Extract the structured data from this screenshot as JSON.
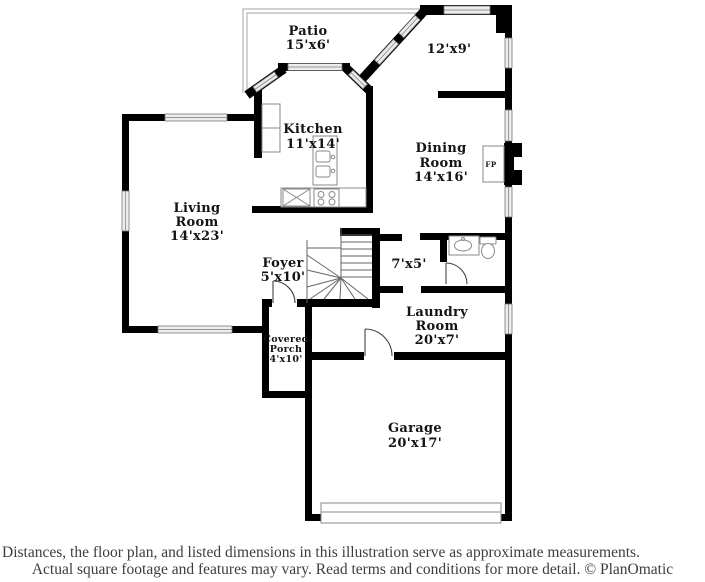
{
  "plan": {
    "rooms": {
      "patio": {
        "lines": [
          "Patio",
          "15'x6'"
        ]
      },
      "breakfast_nook": {
        "lines": [
          "12'x9'"
        ]
      },
      "kitchen": {
        "lines": [
          "Kitchen",
          "11'x14'"
        ]
      },
      "dining_room": {
        "lines": [
          "Dining",
          "Room",
          "14'x16'"
        ]
      },
      "living_room": {
        "lines": [
          "Living",
          "Room",
          "14'x23'"
        ]
      },
      "foyer": {
        "lines": [
          "Foyer",
          "5'x10'"
        ]
      },
      "hallway": {
        "lines": [
          "7'x5'"
        ]
      },
      "laundry_room": {
        "lines": [
          "Laundry",
          "Room",
          "20'x7'"
        ]
      },
      "covered_porch": {
        "lines": [
          "Covered",
          "Porch",
          "4'x10'"
        ]
      },
      "garage": {
        "lines": [
          "Garage",
          "20'x17'"
        ]
      }
    },
    "fireplace": {
      "label": "FP"
    },
    "colors": {
      "wall": "#000000",
      "window_fill": "#ededed",
      "patio_outline": "#b3b3b3",
      "text": "#141414"
    }
  },
  "footer": {
    "line1": "Distances, the floor plan, and listed dimensions in this illustration serve as approximate measurements.",
    "line2": "Actual square footage and features may vary. Read terms and conditions for more detail. © PlanOmatic"
  }
}
